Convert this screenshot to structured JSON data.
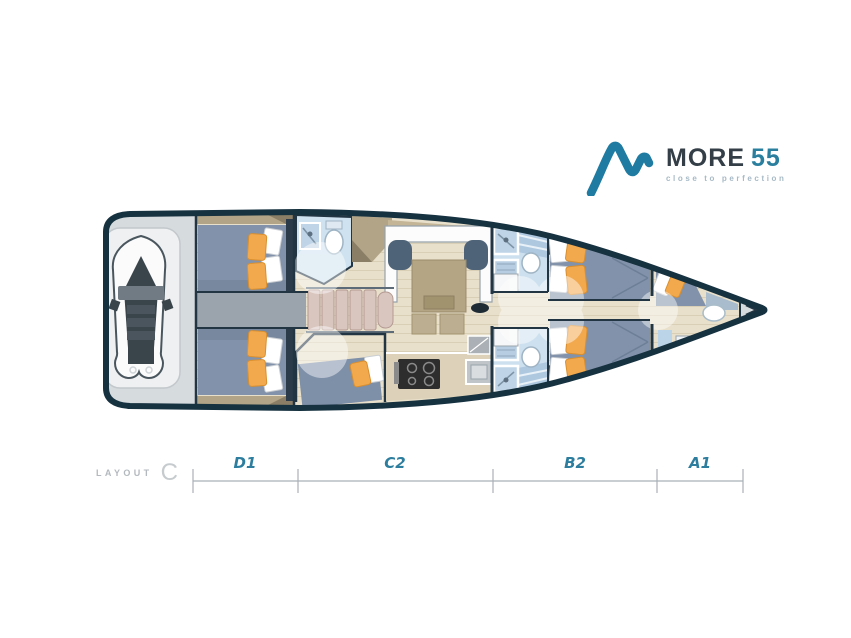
{
  "brand": {
    "name": "MORE",
    "model": "55",
    "tagline": "close to perfection"
  },
  "layout_label": {
    "word": "LAYOUT",
    "variant": "C"
  },
  "ruler": {
    "sections": [
      {
        "label": "D1"
      },
      {
        "label": "C2"
      },
      {
        "label": "B2"
      },
      {
        "label": "A1"
      }
    ]
  },
  "palette": {
    "hull_outline": "#16313f",
    "brand_teal": "#1f7ba1",
    "brand_text_dark": "#333e47",
    "tagline_gray": "#a7bac6",
    "section_label_teal": "#2d7e9e",
    "floor_beige": "#e9e0cb",
    "bed_blue": "#8292aa",
    "pillow_orange": "#f2a84d",
    "bathroom_blue": "#cfe2f0",
    "stern_gray": "#d6dbde",
    "corridor_gray": "#9ba4ac",
    "furniture_tan": "#b2a486",
    "ruler_gray": "#a9b1b7",
    "layout_text_gray": "#b6bcc1"
  }
}
